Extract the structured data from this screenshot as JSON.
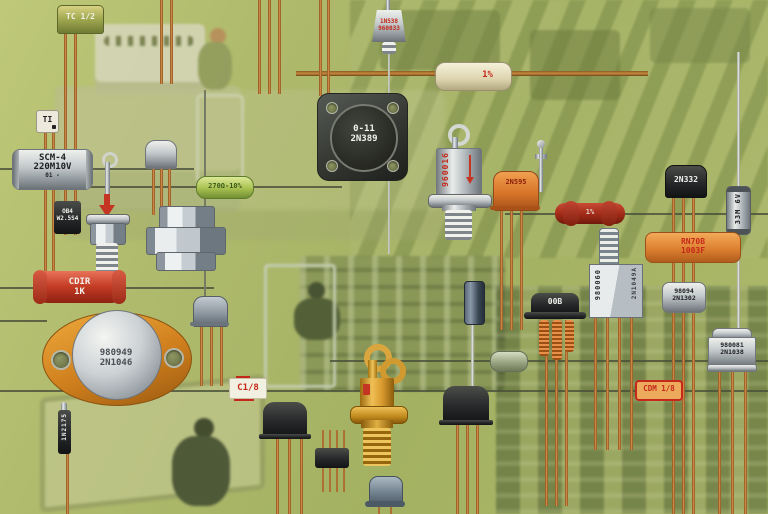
{
  "colors": {
    "background_green": "#aab968",
    "copper_lead": "#c88a3e",
    "red_marking": "#c5281a",
    "orange_body": "#e08a33",
    "silver_body": "#c2c8ca"
  },
  "components": {
    "tc_can": {
      "label": "TC 1/2"
    },
    "ti_part": {
      "label": "TI"
    },
    "scm4_capacitor": {
      "line1": "SCM-4",
      "line2": "220M10V",
      "line3": "01 -"
    },
    "ob4_part": {
      "line1": "OB4",
      "line2": "W2.5S4"
    },
    "cdir_resistor": {
      "line1": "CDIR",
      "line2": "1K"
    },
    "green_resistor": {
      "label": "270Ω-10%"
    },
    "power_transistor": {
      "line1": "980949",
      "line2": "2N1046"
    },
    "diode_1n2175": {
      "label": "1N2175"
    },
    "square_transistor": {
      "line1": "0-11",
      "line2": "2N389"
    },
    "stud_diode_top": {
      "line1": "1N538",
      "line2": "960033"
    },
    "cream_resistor": {
      "label": "1%"
    },
    "stud_diode_center": {
      "label": "960016"
    },
    "orange_transistor": {
      "label": "2N595"
    },
    "red_resistor_right": {
      "label": "1%"
    },
    "transistor_2n332": {
      "label": "2N332"
    },
    "glass_diode": {
      "label": "33M 6V"
    },
    "rn70b_resistor": {
      "line1": "RN70B",
      "line2": "1003F"
    },
    "metal_cube": {
      "left": "980060",
      "right": "2N1049A"
    },
    "transistor_2n1302": {
      "line1": "98094",
      "line2": "2N1302"
    },
    "can_2n1038": {
      "line1": "980081",
      "line2": "2N1038"
    },
    "top_hat_transistor": {
      "label": "00B"
    },
    "label_c18": {
      "label": "C1/8"
    },
    "label_cdm18": {
      "label": "CDM 1/8"
    }
  }
}
